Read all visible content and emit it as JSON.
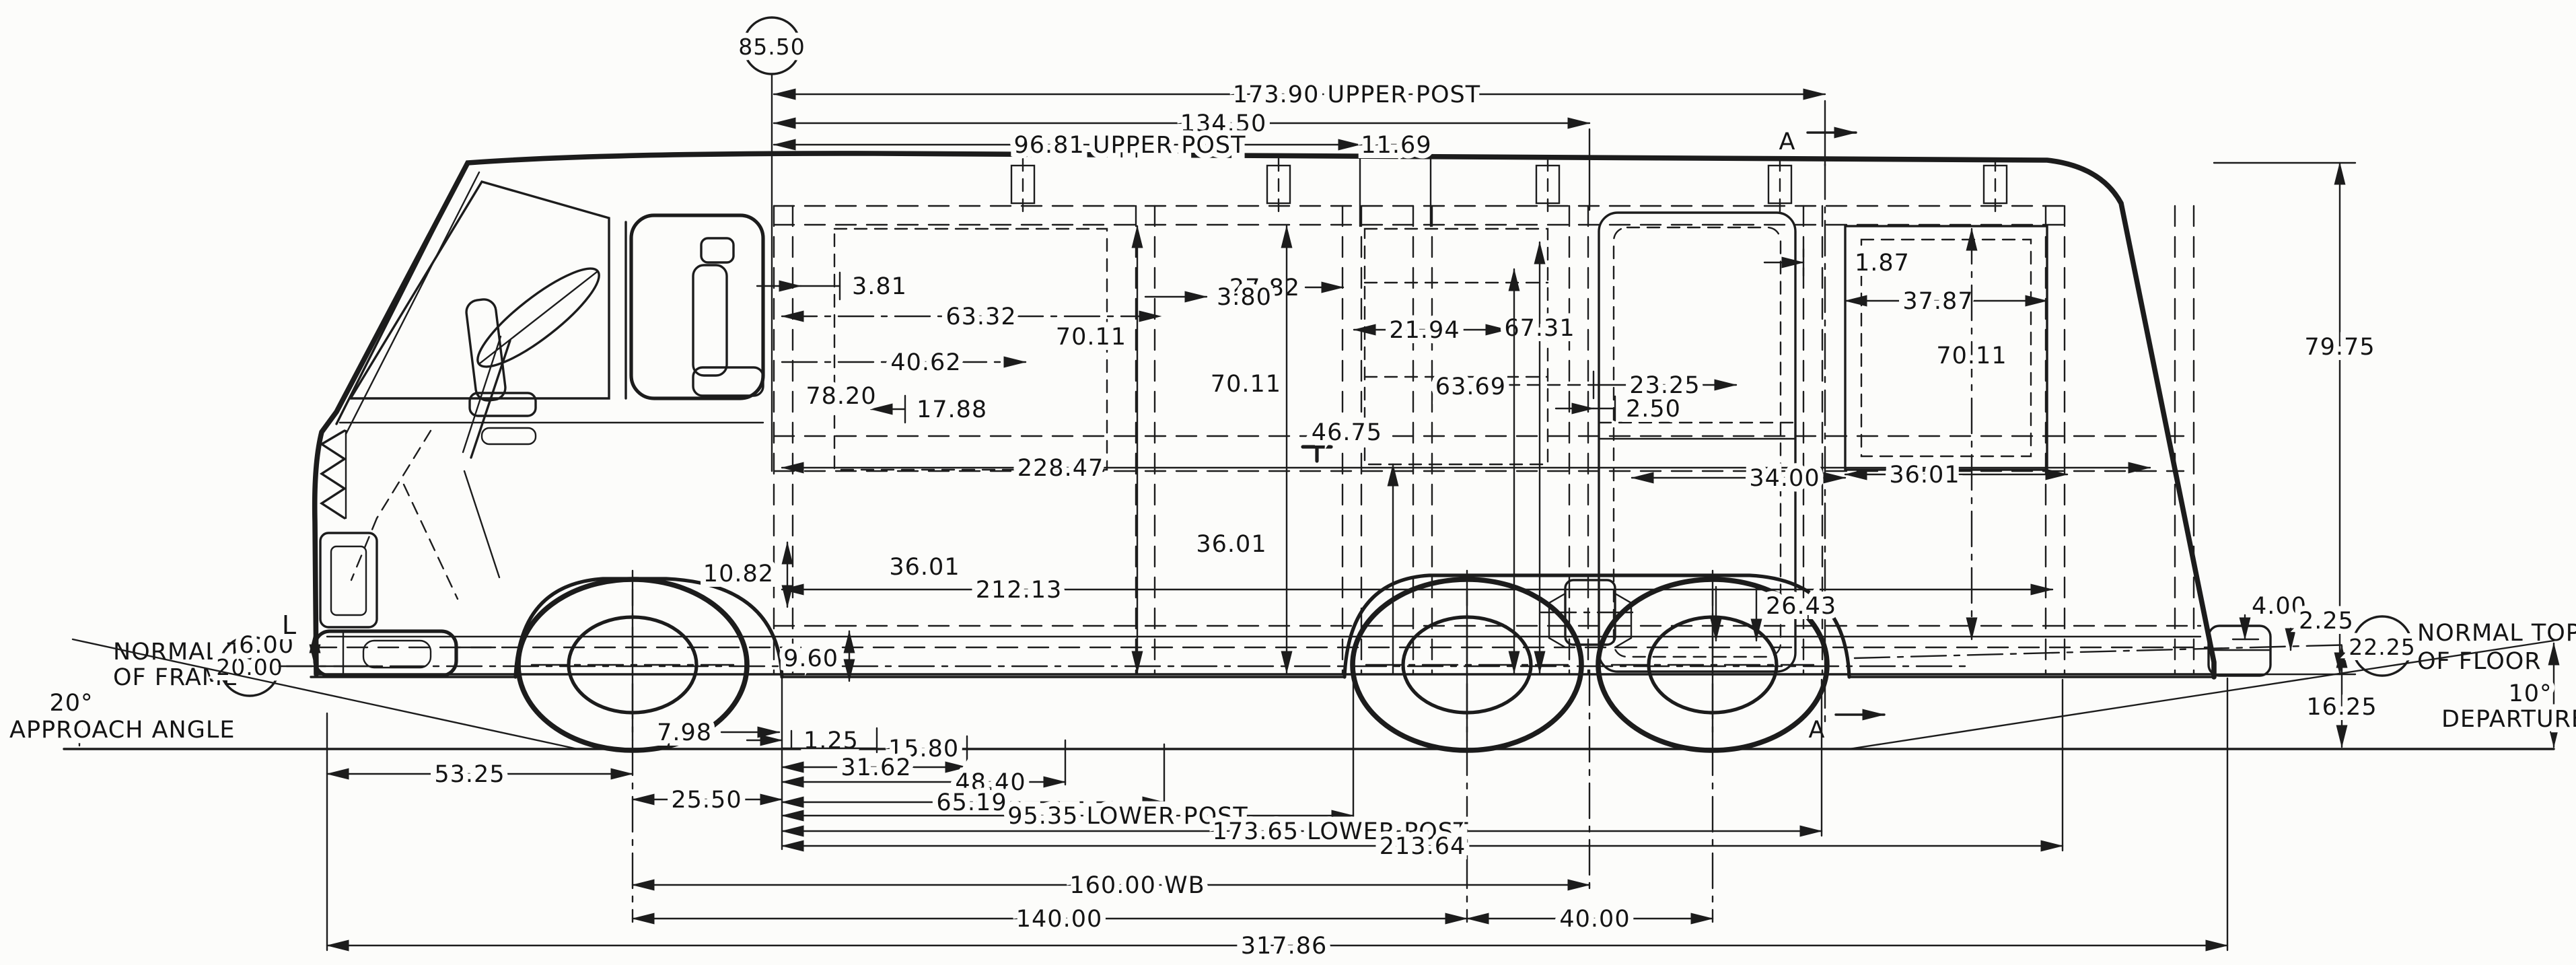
{
  "drawing": {
    "description": "Side elevation dimensional blueprint of a front-wheel-drive motorhome coach",
    "units": "inches"
  },
  "circles": {
    "overall_height": "85.50",
    "frame_height": "20.00",
    "floor_height": "22.25"
  },
  "labels": {
    "upper_post_length": "173.90 UPPER POST",
    "overall_upper": "134.50",
    "upper_post_front": "96.81 UPPER POST",
    "d11_69": "11.69",
    "section_marker": "A",
    "d3_81": "3.81",
    "d3_80": "3.80",
    "d27_82": "27.82",
    "d21_94": "21.94",
    "d1_87": "1.87",
    "d37_87": "37.87",
    "d63_32": "63.32",
    "d70_11": "70.11",
    "d67_31": "67.31",
    "d40_62": "40.62",
    "d63_69": "63.69",
    "d23_25": "23.25",
    "d2_50": "2.50",
    "d78_20": "78.20",
    "d17_88": "17.88",
    "d46_75": "46.75",
    "d79_75": "79.75",
    "d228_47": "228.47",
    "d34_00": "34.00",
    "d36_01": "36.01",
    "d212_13": "212.13",
    "d10_82": "10.82",
    "d9_60": "9.60",
    "d26_43": "26.43",
    "d4_00": "4.00",
    "d2_25": "2.25",
    "d16_25": "16.25",
    "d6_00": "6.00",
    "d7_98": "7.98",
    "d1_25": "1.25",
    "d15_80": "15.80",
    "d31_62": "31.62",
    "d48_40": "48.40",
    "d65_19": "65.19",
    "d53_25": "53.25",
    "d25_50": "25.50",
    "lower_post_front": "95.35 LOWER POST",
    "lower_post_length": "173.65 LOWER POST",
    "d213_64": "213.64",
    "wheelbase": "160.00 WB",
    "d140_00": "140.00",
    "d40_00": "40.00",
    "overall_length": "317.86",
    "datum_mark": "L"
  },
  "annotations": {
    "normal_top": "NORMAL TOP",
    "of_frame": "OF FRAME",
    "of_floor": "OF FLOOR",
    "approach_deg": "20°",
    "approach": "APPROACH ANGLE",
    "departure_deg": "10°",
    "departure": "DEPARTURE"
  }
}
